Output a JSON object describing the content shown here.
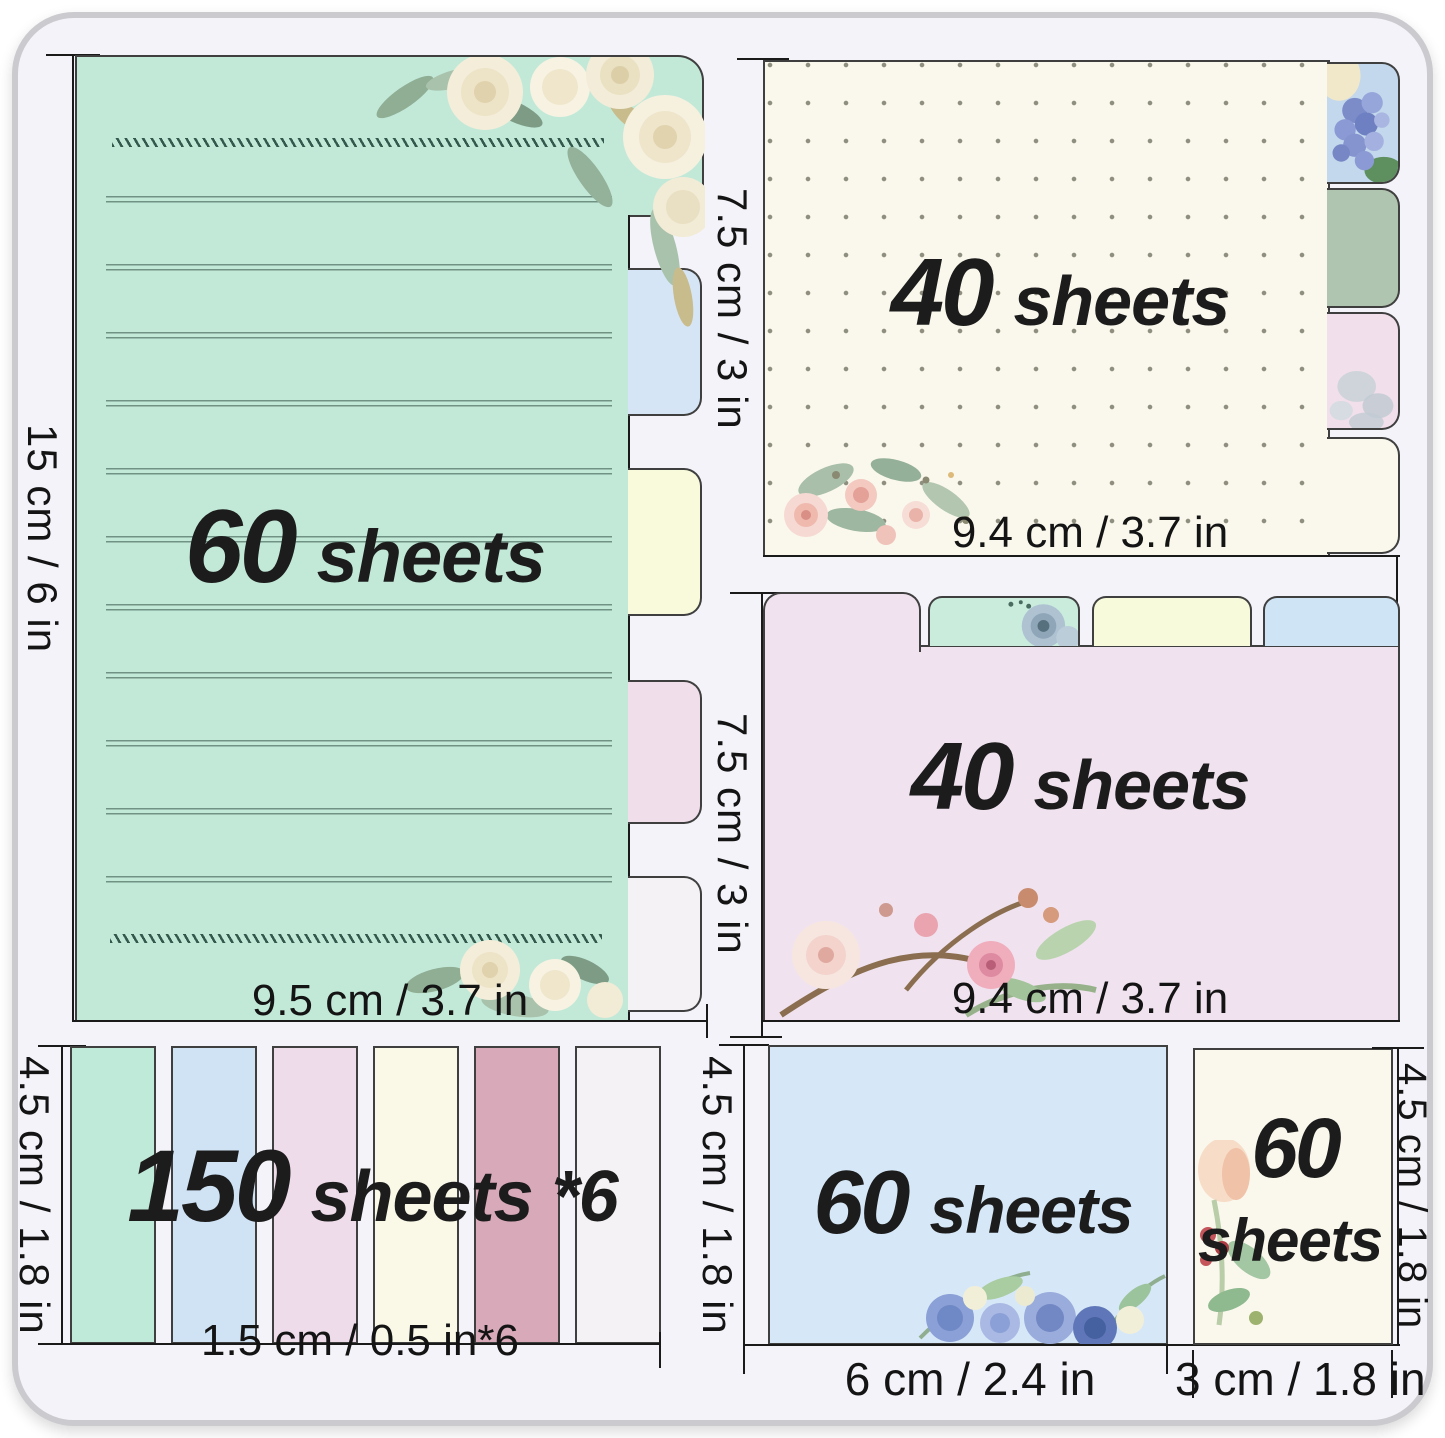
{
  "notes": {
    "lined_pad": {
      "count": "60",
      "unit": "sheets",
      "height_label": "15 cm / 6 in",
      "width_label": "9.5 cm / 3.7 in"
    },
    "dotted_pad": {
      "count": "40",
      "unit": "sheets",
      "height_label": "7.5 cm / 3 in",
      "width_label": "9.4 cm / 3.7 in"
    },
    "plain_pad": {
      "count": "40",
      "unit": "sheets",
      "height_label": "7.5 cm / 3 in",
      "width_label": "9.4 cm / 3.7 in"
    },
    "index_tabs": {
      "count": "150",
      "unit": "sheets *6",
      "height_label": "4.5 cm / 1.8 in",
      "width_label": "1.5 cm / 0.5 in*6"
    },
    "blue_pad": {
      "count": "60",
      "unit": "sheets",
      "height_label": "4.5 cm / 1.8 in",
      "width_label": "6 cm / 2.4 in"
    },
    "small_pad": {
      "count": "60",
      "unit": "sheets",
      "height_label": "4.5 cm / 1.8 in",
      "width_label": "3 cm / 1.8 in"
    }
  },
  "colors": {
    "mint_note": "#C2E9D8",
    "dotted_note": "#FAF8EC",
    "plain_note": "#F0E3EF",
    "blue_note": "#D6E8F7",
    "small_note": "#FAF8EC",
    "strips": [
      "#BFE9D8",
      "#CFE3F5",
      "#EFDCEA",
      "#FAF9E8",
      "#D8A9B9",
      "#F4F2F4"
    ],
    "lined_side_tabs": [
      "#D6E5F5",
      "#F8FADB",
      "#F1DEEB",
      "#F4F2F5"
    ],
    "dotted_side_tabs": [
      "#C3D8EC",
      "#AFC5AF",
      "#F1DFEB",
      "#FAF8EC"
    ],
    "plain_top_tabs": [
      "#F0E3EF",
      "#C9ECDD",
      "#F8FADC",
      "#CFE4F5"
    ]
  }
}
